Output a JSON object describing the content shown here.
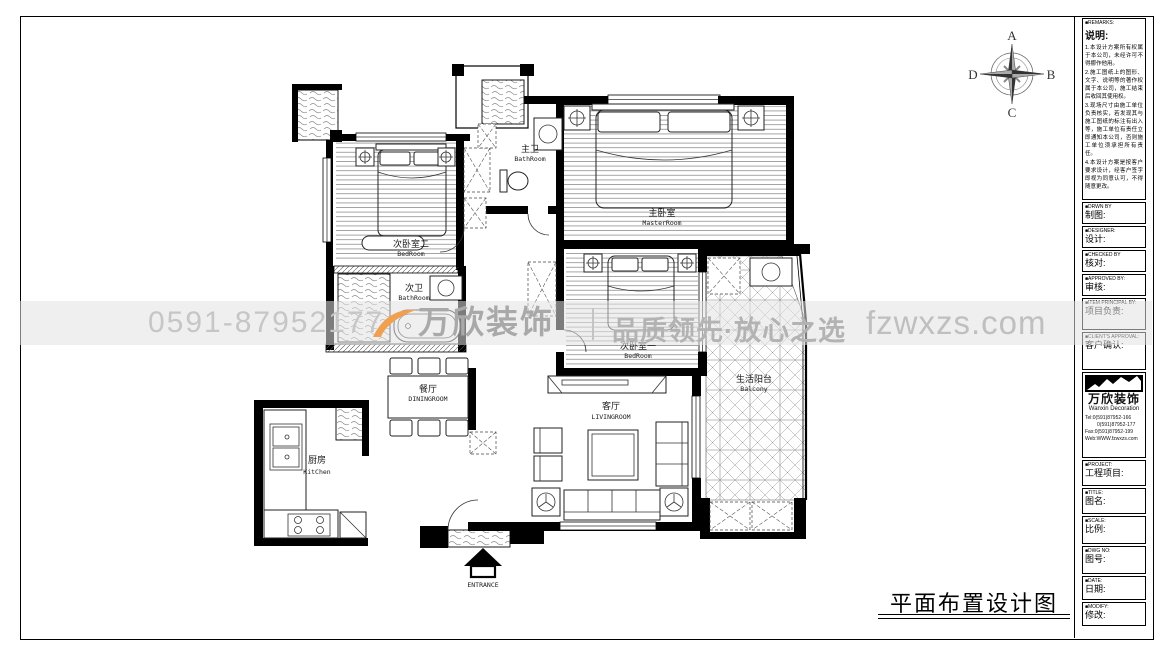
{
  "sheet_title": "平面布置设计图",
  "compass": {
    "top": "A",
    "right": "B",
    "bottom": "C",
    "left": "D"
  },
  "plan": {
    "rooms": [
      {
        "id": "bedroom2",
        "zh": "次卧室二",
        "en": "BedRoom"
      },
      {
        "id": "master-bath",
        "zh": "主卫",
        "en": "BathRoom"
      },
      {
        "id": "master-bedroom",
        "zh": "主卧室",
        "en": "MasterRoom"
      },
      {
        "id": "second-bath",
        "zh": "次卫",
        "en": "BathRoom"
      },
      {
        "id": "bedroom1",
        "zh": "次卧室一",
        "en": "BedRoom"
      },
      {
        "id": "balcony",
        "zh": "生活阳台",
        "en": "Balcony"
      },
      {
        "id": "dining",
        "zh": "餐厅",
        "en": "DININGROOM"
      },
      {
        "id": "living",
        "zh": "客厅",
        "en": "LIVINGROOM"
      },
      {
        "id": "kitchen",
        "zh": "厨房",
        "en": "KitChen"
      }
    ],
    "entrance_label": "ENTRANCE"
  },
  "watermark": {
    "phone": "0591-87952177",
    "brand": "万欣装饰",
    "slogan": "品质领先·放心之选",
    "site": "fzwxzs.com",
    "accent": "#f0a050"
  },
  "titleblock": {
    "remarks_en": "■REMARKS:",
    "remarks_zh": "说明:",
    "notes": [
      "1.本设计方案所有权属于本公司，未经许可不得挪作他用。",
      "2.施工图纸上的图形、文字、说明等的著作权属于本公司，施工结束后收回其使用权。",
      "3.现场尺寸由施工单位负责核实，若发现其与施工图纸的标注有出入等，施工单位有责任立即通知本公司，否则施工单位须承担所有责任。",
      "4.本设计方案是按客户要求设计，经客户签字即视为同意认可，不得随意更改。"
    ],
    "fields": [
      {
        "en": "■DRWN BY",
        "zh": "制图:"
      },
      {
        "en": "■DESIGNER:",
        "zh": "设计:"
      },
      {
        "en": "■CHECKED BY",
        "zh": "核对:"
      },
      {
        "en": "■APPROVED BY:",
        "zh": "审核:"
      },
      {
        "en": "■ITEM PRINCIPAL BY:",
        "zh": "项目负责:"
      },
      {
        "en": "■CLIENT'S APPROVAL:",
        "zh": "客户确认:"
      },
      {
        "en": "■PROJECT:",
        "zh": "工程项目:"
      },
      {
        "en": "■TITLE:",
        "zh": "图名:"
      },
      {
        "en": "■SCALE:",
        "zh": "比例:"
      },
      {
        "en": "■DWG NO:",
        "zh": "图号:"
      },
      {
        "en": "■DATE:",
        "zh": "日期:"
      },
      {
        "en": "■MODIFY:",
        "zh": "修改:"
      }
    ],
    "company": {
      "logo_zh": "万欣装饰",
      "logo_en": "Wanxin Decoration",
      "tel1": "Tel:0(591)87952-166",
      "tel2": "0(591)87952-177",
      "fax": "Fax:0(591)87952-199",
      "web": "Web:WWW.fzwxzs.com"
    }
  }
}
